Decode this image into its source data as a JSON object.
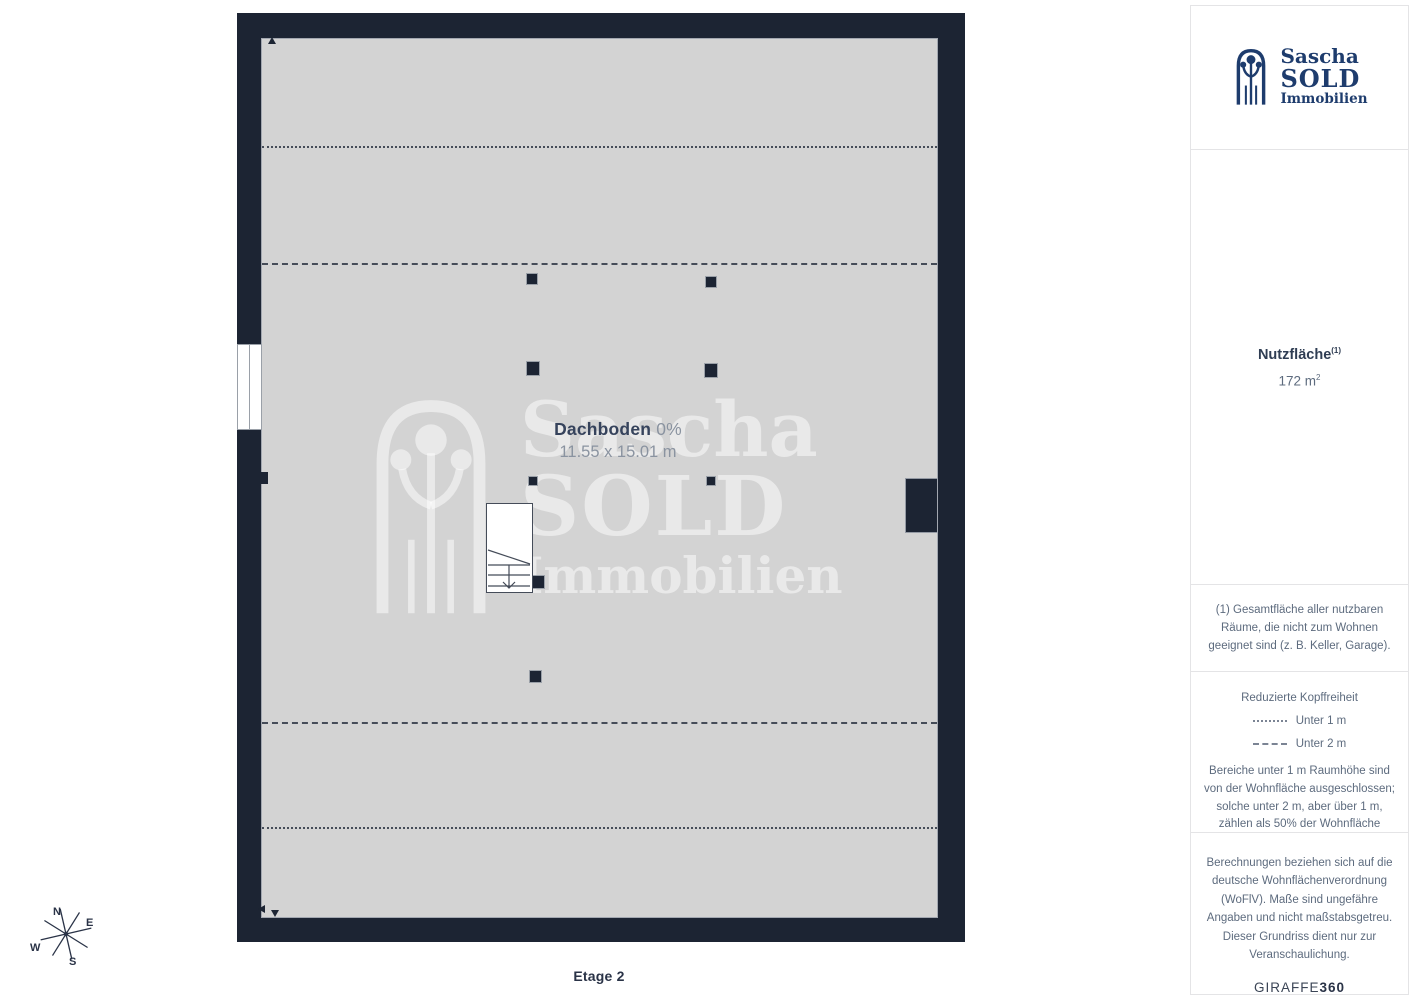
{
  "plan": {
    "room_name": "Dachboden",
    "room_percent": "0%",
    "room_dimensions": "11.55 x 15.01 m",
    "floor_label": "Etage 2"
  },
  "compass": {
    "north": "N",
    "east": "E",
    "south": "S",
    "west": "W"
  },
  "watermark": {
    "line1": "Sascha",
    "line2": "SOLD",
    "line3": "Immobilien"
  },
  "sidebar": {
    "logo": {
      "line1": "Sascha",
      "line2": "SOLD",
      "line3": "Immobilien"
    },
    "area": {
      "label": "Nutzfläche",
      "sup": "(1)",
      "value": "172 m",
      "value_sup": "2"
    },
    "footnote": "(1) Gesamtfläche aller nutzbaren Räume, die nicht zum Wohnen geeignet sind (z. B. Keller, Garage).",
    "legend": {
      "title": "Reduzierte Kopffreiheit",
      "items": [
        {
          "label": "Unter 1 m"
        },
        {
          "label": "Unter 2 m"
        }
      ],
      "note": "Bereiche unter 1 m Raumhöhe sind von der Wohnfläche ausgeschlossen; solche unter 2 m, aber über 1 m, zählen als 50% der Wohnfläche"
    },
    "disclaimer": "Berechnungen beziehen sich auf die deutsche Wohnflächenverordnung (WoFlV). Maße sind ungefähre Angaben und nicht maßstabsgetreu. Dieser Grundriss dient nur zur Veranschaulichung.",
    "brand": {
      "name": "GIRAFFE",
      "suffix": "360"
    }
  },
  "colors": {
    "wall": "#1c2433",
    "floor": "#d3d3d3",
    "logo_navy": "#1e3c6d",
    "text_dark": "#2f3d53",
    "text_muted": "#5d6b7e"
  }
}
